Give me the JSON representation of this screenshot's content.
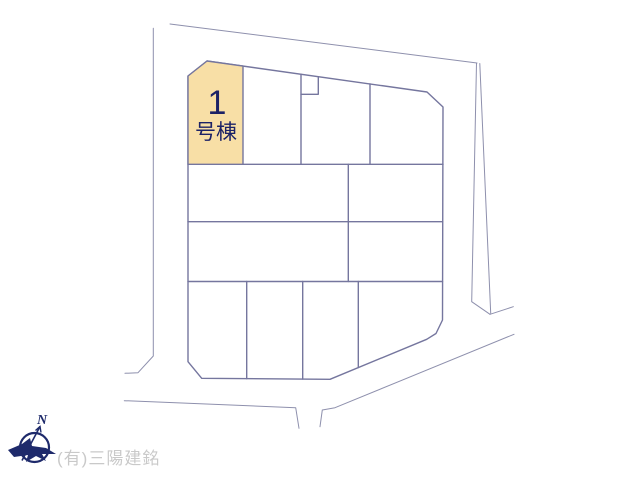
{
  "site_plan": {
    "highlighted_lot": {
      "number": "1",
      "suffix": "号棟"
    },
    "compass_label": "N",
    "watermark": "(有)三陽建銘",
    "colors": {
      "lot_fill": "#f8dfa6",
      "plot_line": "#75769e",
      "road_line": "#8e90ad",
      "lot_text": "#1c2266",
      "compass": "#1e2a6b",
      "watermark_text": "#c9c9c9"
    }
  }
}
